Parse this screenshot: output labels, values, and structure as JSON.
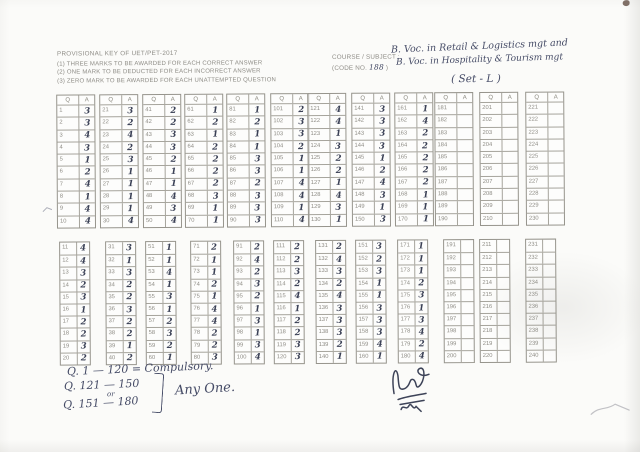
{
  "page": {
    "paper_color": "#fbfbf9",
    "ink_color": "#3b4156",
    "print_color": "#8e8c86"
  },
  "header": {
    "title": "PROVISIONAL  KEY OF UET/PET-2017",
    "instructions": [
      "(1) THREE MARKS TO BE AWARDED FOR EACH CORRECT ANSWER",
      "(2) ONE MARK TO BE DEDUCTED FOR EACH INCORRECT ANSWER",
      "(3) ZERO MARK TO BE AWARDED FOR EACH UNATTEMPTED QUESTION"
    ]
  },
  "course": {
    "label": "COURSE / SUBJECT :",
    "code_prefix": "(CODE NO. ",
    "code_value": "188",
    "code_suffix": " )",
    "line1": "B. Voc. in Retail & Logistics mgt and",
    "line2": "B. Voc. in Hospitality & Tourism mgt",
    "set_label": "( Set - L )"
  },
  "answer_key": {
    "columns": {
      "q": "Q",
      "a": "A"
    },
    "top_row_tables": [
      {
        "start": 1,
        "answers": [
          "3",
          "3",
          "4",
          "3",
          "1",
          "2",
          "4",
          "1",
          "4",
          "4"
        ]
      },
      {
        "start": 21,
        "answers": [
          "3",
          "2",
          "4",
          "2",
          "3",
          "1",
          "1",
          "1",
          "1",
          "4"
        ]
      },
      {
        "start": 41,
        "answers": [
          "2",
          "2",
          "3",
          "3",
          "2",
          "1",
          "1",
          "4",
          "3",
          "4"
        ]
      },
      {
        "start": 61,
        "answers": [
          "1",
          "2",
          "1",
          "2",
          "2",
          "2",
          "2",
          "3",
          "1",
          "1"
        ]
      },
      {
        "start": 81,
        "answers": [
          "1",
          "2",
          "1",
          "1",
          "3",
          "3",
          "2",
          "3",
          "3",
          "3"
        ]
      },
      {
        "start": 101,
        "answers": [
          "2",
          "3",
          "3",
          "2",
          "1",
          "1",
          "4",
          "4",
          "1",
          "4"
        ]
      },
      {
        "start": 121,
        "answers": [
          "4",
          "4",
          "1",
          "3",
          "2",
          "2",
          "1",
          "4",
          "3",
          "1"
        ]
      },
      {
        "start": 141,
        "answers": [
          "3",
          "3",
          "3",
          "3",
          "1",
          "2",
          "4",
          "3",
          "1",
          "3"
        ]
      },
      {
        "start": 161,
        "answers": [
          "1",
          "4",
          "2",
          "2",
          "2",
          "2",
          "2",
          "1",
          "1",
          "1"
        ]
      },
      {
        "start": 181,
        "answers": [
          "",
          "",
          "",
          "",
          "",
          "",
          "",
          "",
          "",
          ""
        ]
      },
      {
        "start": 201,
        "answers": [
          "",
          "",
          "",
          "",
          "",
          "",
          "",
          "",
          "",
          ""
        ]
      },
      {
        "start": 221,
        "answers": [
          "",
          "",
          "",
          "",
          "",
          "",
          "",
          "",
          "",
          ""
        ]
      }
    ],
    "bottom_row_tables": [
      {
        "start": 11,
        "answers": [
          "4",
          "4",
          "3",
          "2",
          "3",
          "1",
          "2",
          "2",
          "3",
          "2"
        ]
      },
      {
        "start": 31,
        "answers": [
          "3",
          "1",
          "3",
          "2",
          "2",
          "3",
          "2",
          "2",
          "1",
          "2"
        ]
      },
      {
        "start": 51,
        "answers": [
          "1",
          "1",
          "4",
          "1",
          "3",
          "1",
          "2",
          "3",
          "2",
          "1"
        ]
      },
      {
        "start": 71,
        "answers": [
          "2",
          "1",
          "1",
          "2",
          "1",
          "4",
          "4",
          "2",
          "2",
          "3"
        ]
      },
      {
        "start": 91,
        "answers": [
          "2",
          "4",
          "2",
          "3",
          "2",
          "1",
          "3",
          "1",
          "3",
          "4"
        ]
      },
      {
        "start": 111,
        "answers": [
          "2",
          "2",
          "3",
          "2",
          "4",
          "1",
          "2",
          "2",
          "3",
          "3"
        ]
      },
      {
        "start": 131,
        "answers": [
          "2",
          "4",
          "3",
          "2",
          "4",
          "3",
          "3",
          "3",
          "2",
          "1"
        ]
      },
      {
        "start": 151,
        "answers": [
          "3",
          "2",
          "3",
          "1",
          "1",
          "3",
          "3",
          "3",
          "4",
          "1"
        ]
      },
      {
        "start": 171,
        "answers": [
          "1",
          "1",
          "1",
          "2",
          "3",
          "1",
          "3",
          "4",
          "2",
          "4"
        ]
      },
      {
        "start": 191,
        "answers": [
          "",
          "",
          "",
          "",
          "",
          "",
          "",
          "",
          "",
          ""
        ]
      },
      {
        "start": 211,
        "answers": [
          "",
          "",
          "",
          "",
          "",
          "",
          "",
          "",
          "",
          ""
        ]
      },
      {
        "start": 231,
        "answers": [
          "",
          "",
          "",
          "",
          "",
          "",
          "",
          "",
          "",
          ""
        ]
      }
    ]
  },
  "notes": {
    "line1_prefix": "Q.",
    "line1": "1 — 120 = Compulsory.",
    "line2_prefix": "Q.",
    "line2": "121 — 150",
    "or_label": "or",
    "line3_prefix": "Q.",
    "line3": "151 — 180",
    "any_one": "Any One."
  }
}
